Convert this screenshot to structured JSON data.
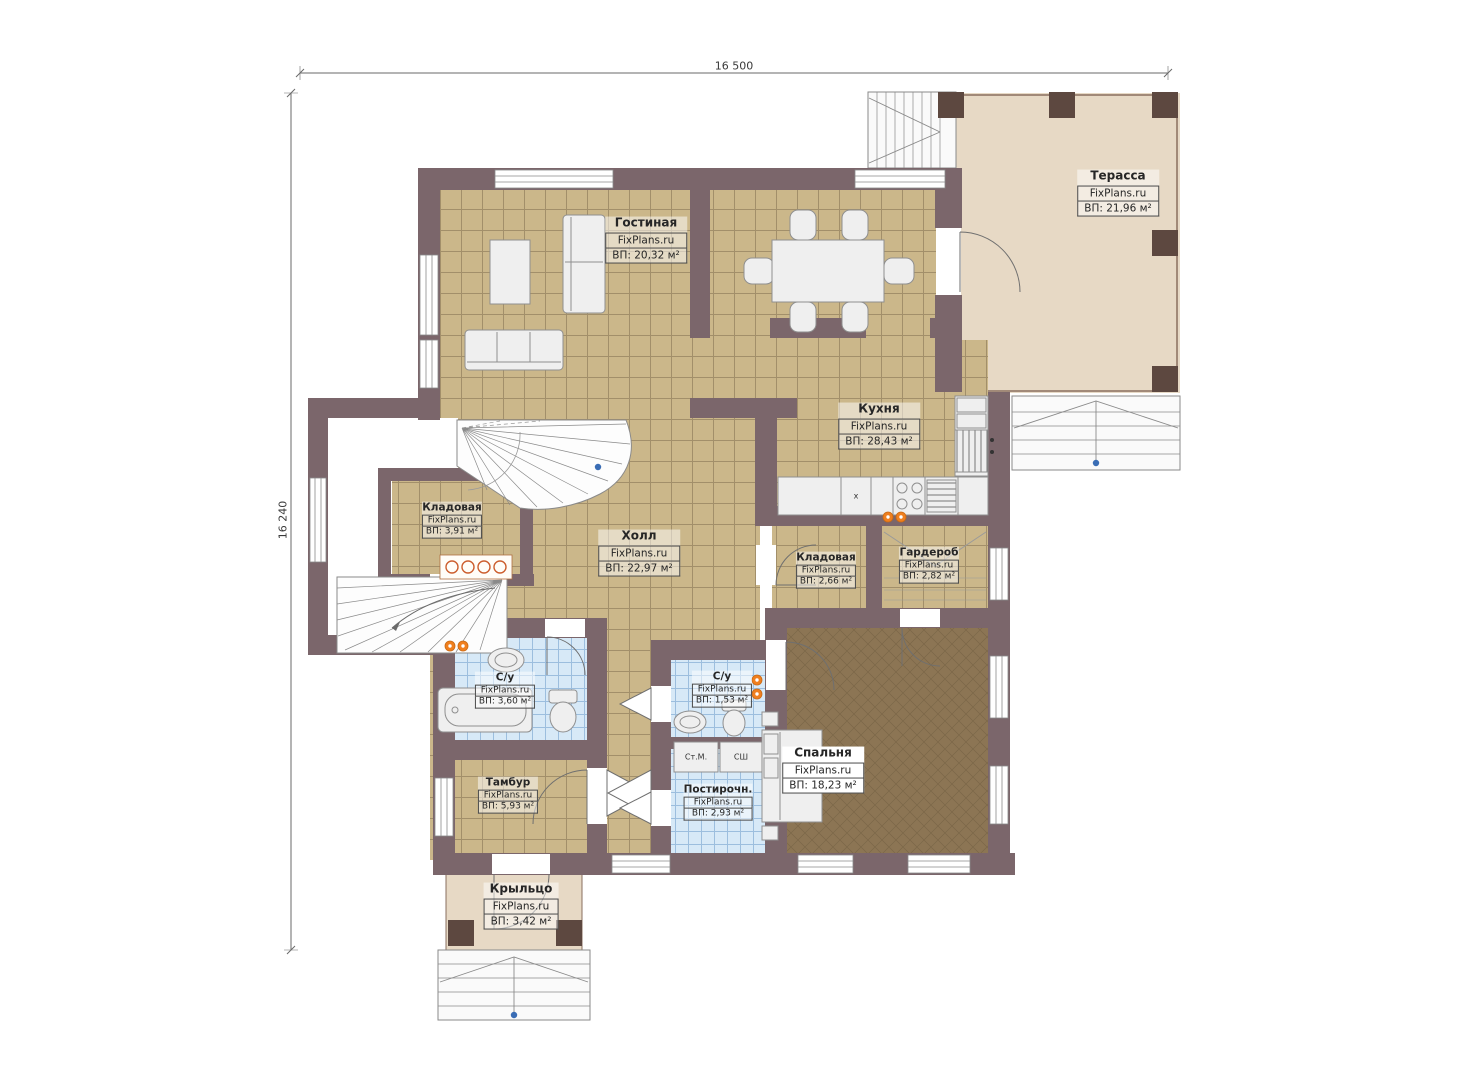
{
  "plan": {
    "watermark": "FixPlans.ru",
    "dimensions": {
      "width_label": "16 500",
      "height_label": "16 240"
    },
    "rooms": [
      {
        "name": "Терасса",
        "area": "ВП: 21,96 м²"
      },
      {
        "name": "Гостиная",
        "area": "ВП: 20,32 м²"
      },
      {
        "name": "Кухня",
        "area": "ВП: 28,43 м²"
      },
      {
        "name": "Холл",
        "area": "ВП: 22,97 м²"
      },
      {
        "name": "Кладовая",
        "area": "ВП: 3,91 м²"
      },
      {
        "name": "Кладовая",
        "area": "ВП: 2,66 м²"
      },
      {
        "name": "Гардероб",
        "area": "ВП: 2,82 м²"
      },
      {
        "name": "С/у",
        "area": "ВП: 3,60 м²"
      },
      {
        "name": "С/у",
        "area": "ВП: 1,53 м²"
      },
      {
        "name": "Спальня",
        "area": "ВП: 18,23 м²"
      },
      {
        "name": "Тамбур",
        "area": "ВП: 5,93 м²"
      },
      {
        "name": "Постирочн.",
        "area": "ВП: 2,93 м²"
      },
      {
        "name": "Крыльцо",
        "area": "ВП: 3,42 м²"
      }
    ],
    "appliances": {
      "washer": "Ст.М.",
      "dryer": "СШ",
      "kitchen_marker": "x"
    },
    "colors": {
      "wall": "#7b666b",
      "pillar": "#5d4840",
      "tile": "#cbb78a",
      "tile_grid": "#a28f6a",
      "terrace_floor": "#e7d9c5",
      "bedroom_floor": "#8c7554",
      "bath_tile": "#d7e9f7",
      "bath_grid": "#9cbede",
      "radiator": "#f07f1e",
      "marker_blue": "#3a6db5"
    }
  }
}
